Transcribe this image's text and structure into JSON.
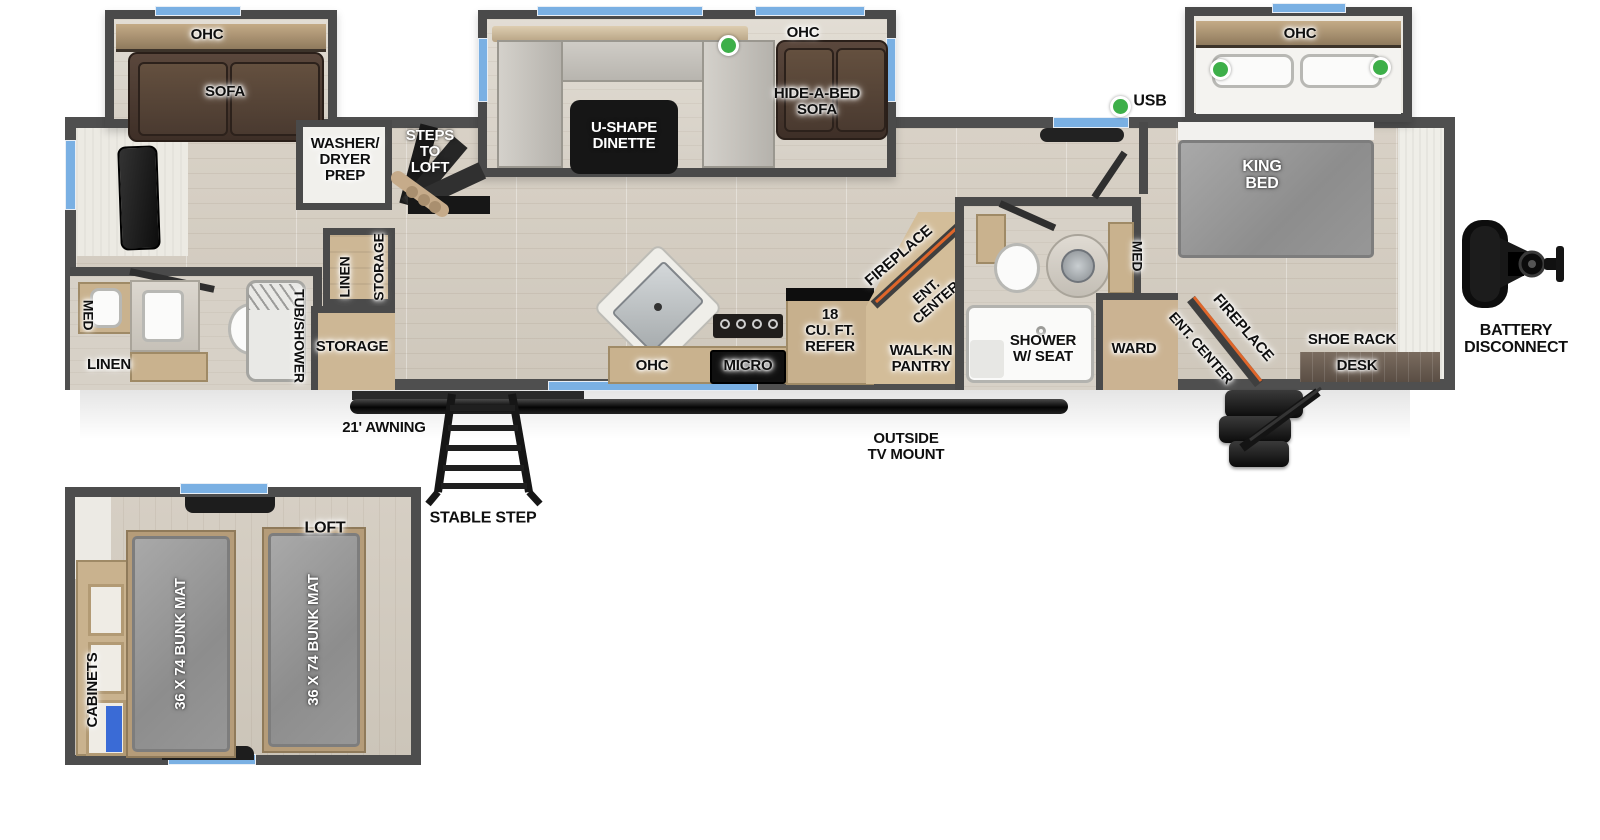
{
  "title": "travel trailer floorplan with loft",
  "colors": {
    "wall": "#4f4f4f",
    "floor_wood": "#d5cec3",
    "window_blue": "#7ab0e3",
    "usb_green": "#3daf49",
    "fireplace_accent": "#e0662a",
    "sofa_brown": "#4a3a31",
    "mattress_gray": "#9a9a9a",
    "cabinet_tan": "#c9b28e",
    "table_black": "#1a1a1a"
  },
  "labels": {
    "rear_slide": {
      "ohc": "OHC",
      "sofa": "SOFA"
    },
    "dinette_slide": {
      "ohc": "OHC",
      "dinette": "U-SHAPE\nDINETTE",
      "hide_a_bed": "HIDE-A-BED\nSOFA"
    },
    "king_slide": {
      "ohc": "OHC"
    },
    "bedroom": {
      "usb": "USB",
      "king_bed": "KING\nBED",
      "ward": "WARD",
      "fireplace": "FIREPLACE",
      "ent_center": "ENT. CENTER",
      "shoe_rack": "SHOE RACK",
      "desk": "DESK"
    },
    "mid": {
      "washer_dryer": "WASHER/\nDRYER\nPREP",
      "steps_to_loft": "STEPS\nTO\nLOFT",
      "linen": "LINEN",
      "storage": "STORAGE",
      "storage_room": "STORAGE"
    },
    "rear_bath": {
      "med": "MED",
      "linen": "LINEN",
      "tub_shower": "TUB/SHOWER"
    },
    "kitchen": {
      "ohc": "OHC",
      "micro": "MICRO",
      "refer": "18\nCU. FT.\nREFER",
      "fireplace": "FIREPLACE",
      "ent_center": "ENT.\nCENTER",
      "pantry": "WALK-IN\nPANTRY"
    },
    "mid_bath": {
      "shower": "SHOWER\nW/ SEAT",
      "med": "MED"
    },
    "exterior": {
      "battery": "BATTERY\nDISCONNECT",
      "awning": "21' AWNING",
      "stable_step": "STABLE STEP",
      "tv_mount": "OUTSIDE\nTV MOUNT"
    },
    "loft": {
      "title": "LOFT",
      "cabinets": "CABINETS",
      "bunk_left": "36 X 74 BUNK MAT",
      "bunk_right": "36 X 74 BUNK MAT"
    }
  }
}
